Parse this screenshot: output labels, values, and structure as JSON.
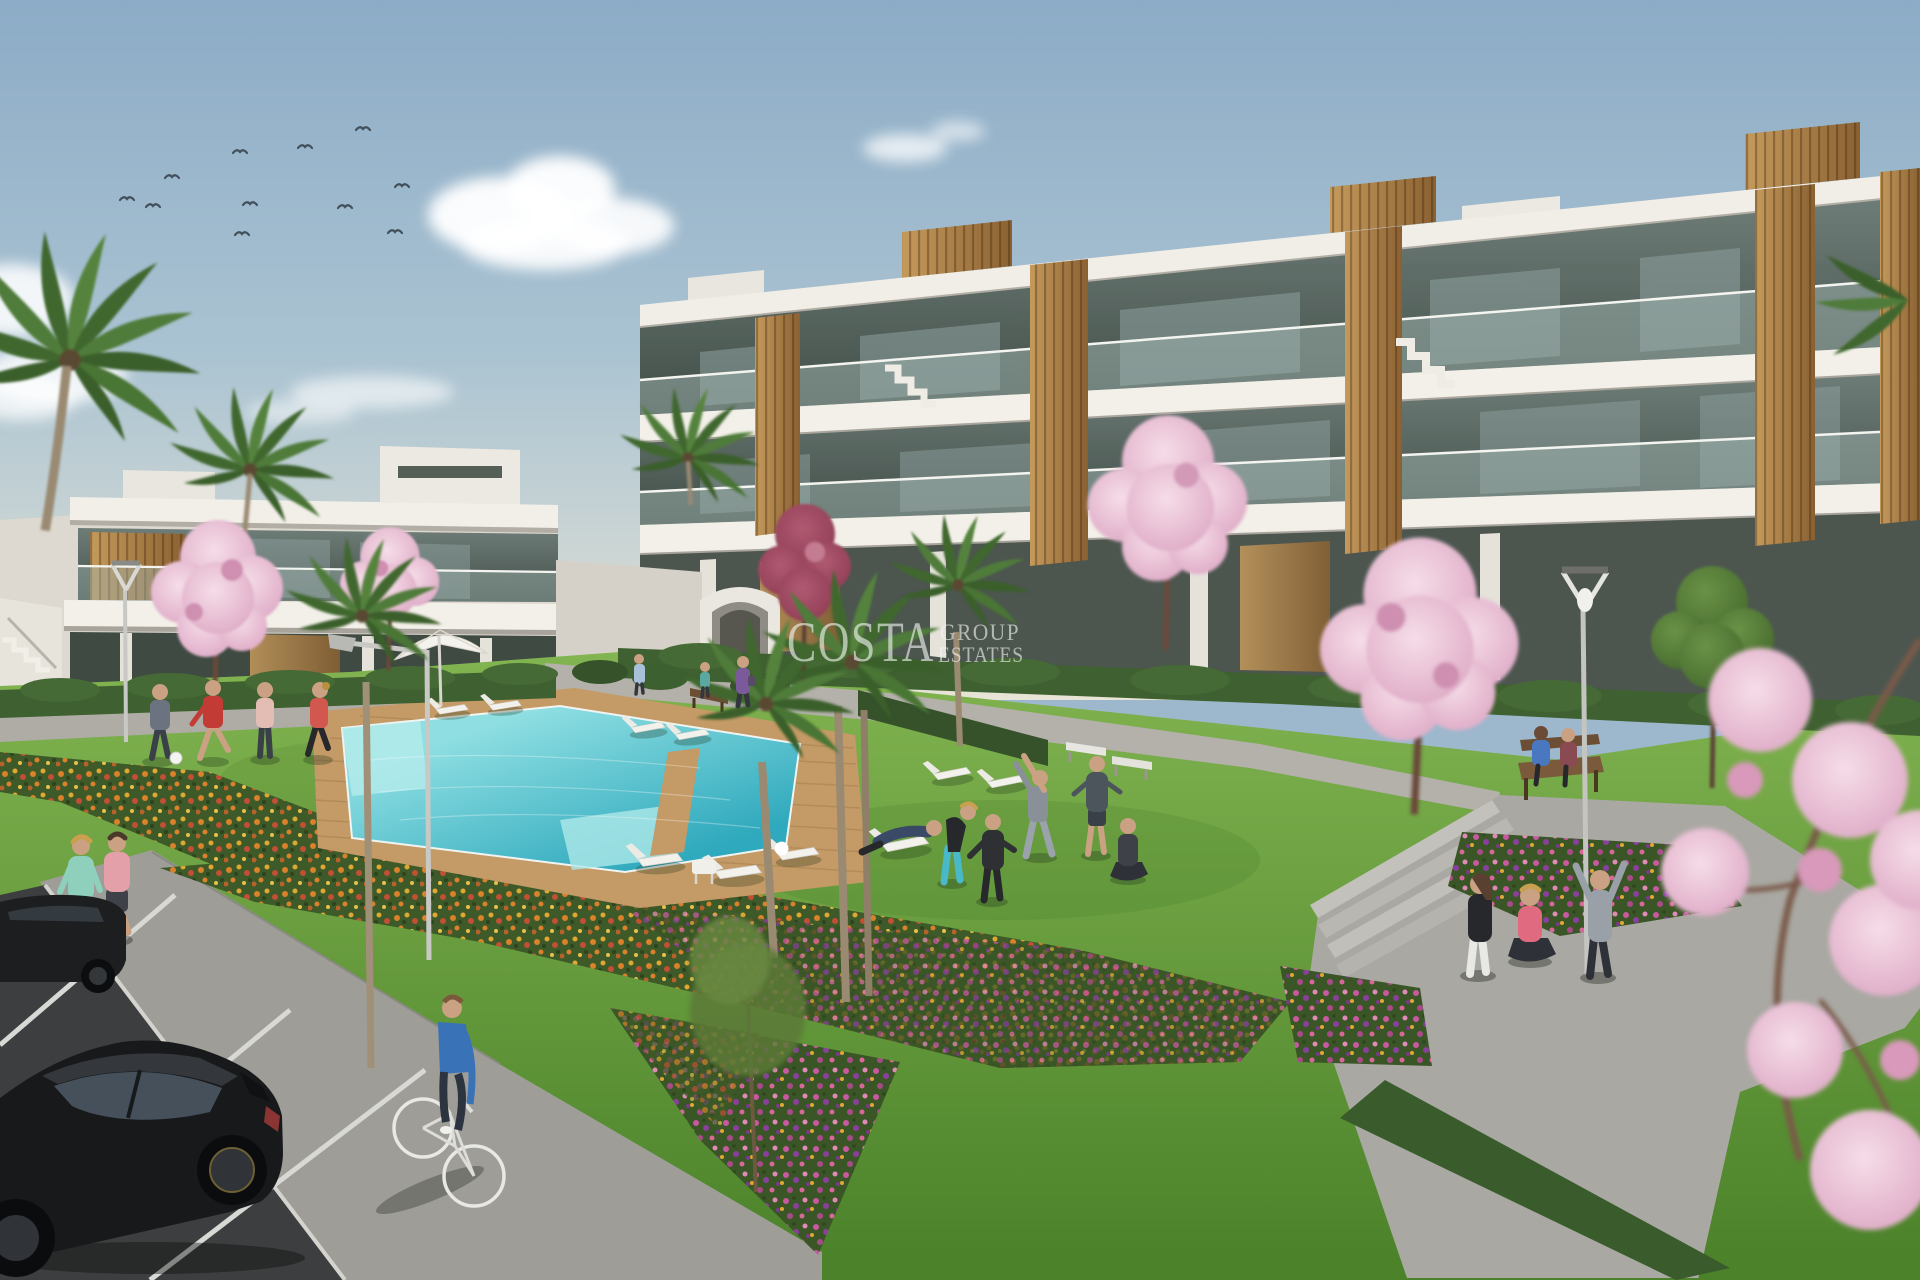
{
  "watermark": {
    "brand": "COSTA",
    "word1": "GROUP",
    "word2": "ESTATES"
  },
  "palette": {
    "sky_top": "#8cabc6",
    "sky_mid": "#aac3d2",
    "sky_low": "#cdd6d4",
    "sky_horizon": "#e8e4d6",
    "building_white": "#efece4",
    "building_shade": "#d9d5cc",
    "wood_light": "#c59a5c",
    "wood_dark": "#8a6132",
    "glass_light": "#6f7d78",
    "glass_dark": "#414e48",
    "lawn_far": "#83b551",
    "lawn_near": "#4a8129",
    "pool_far": "#8fdfe2",
    "pool_near": "#2fa9bd",
    "deck_wood": "#c49a66",
    "path_gray": "#a9a8a2",
    "sidewalk_gray": "#9e9d98",
    "asphalt": "#3c3e40",
    "hedge_green": "#3f6030",
    "blossom_pink": "#e7b6cc",
    "flower_orange": "#d9822b",
    "flower_magenta": "#c858a0",
    "flower_purple": "#8a3f9e",
    "car_black": "#17191b"
  },
  "scene": {
    "birds_count": 11,
    "palm_count": 7,
    "blossom_tree_count": 6
  }
}
